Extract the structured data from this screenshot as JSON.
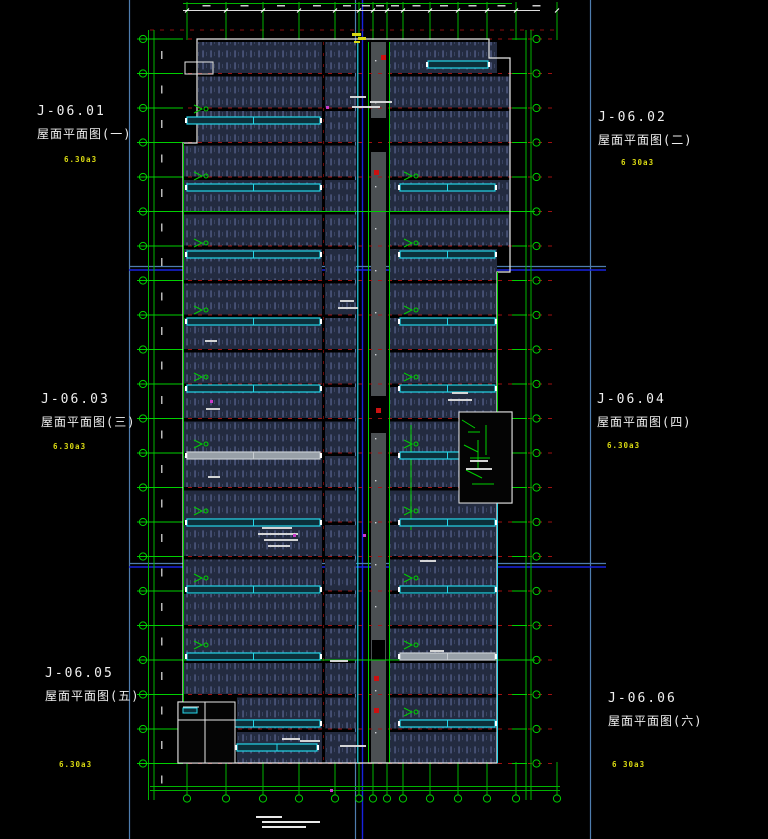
{
  "sheet": {
    "background": "#000000",
    "labels": [
      {
        "code": "J-06.01",
        "title": "屋面平面图(一)",
        "rev": "6.30a3",
        "x": 37,
        "y": 104,
        "rev_x": 64,
        "rev_y": 155
      },
      {
        "code": "J-06.02",
        "title": "屋面平面图(二)",
        "rev": "6 30a3",
        "x": 598,
        "y": 110,
        "rev_x": 621,
        "rev_y": 158
      },
      {
        "code": "J-06.03",
        "title": "屋面平面图(三)",
        "rev": "6.30a3",
        "x": 41,
        "y": 392,
        "rev_x": 53,
        "rev_y": 442
      },
      {
        "code": "J-06.04",
        "title": "屋面平面图(四)",
        "rev": "6.30a3",
        "x": 597,
        "y": 392,
        "rev_x": 607,
        "rev_y": 441
      },
      {
        "code": "J-06.05",
        "title": "屋面平面图(五)",
        "rev": "6.30a3",
        "x": 45,
        "y": 666,
        "rev_x": 59,
        "rev_y": 760
      },
      {
        "code": "J-06.06",
        "title": "屋面平面图(六)",
        "rev": "6 30a3",
        "x": 608,
        "y": 691,
        "rev_x": 612,
        "rev_y": 760
      }
    ]
  },
  "drawing": {
    "colors": {
      "bg": "#000000",
      "divider_light": "#4e7dae",
      "divider_bright": "#1822e0",
      "panel_base": "#232b40",
      "panel_dash": "#49547a",
      "corridor": "#4b5053",
      "axis_red": "#b01212",
      "grid_green": "#00b400",
      "grid_green_bright": "#00d000",
      "outline_white": "#e8e8e8",
      "skylight_cyan": "#25d5e8",
      "skylight_fill": "#0c2f3a",
      "skylight_gray": "#98a0a8",
      "skylight_gray_edge": "#c8cdd2",
      "rev_yellow": "#d9d912",
      "magenta": "#cc3ccc",
      "red_block": "#cc1111",
      "white_bits": "#dddddd"
    },
    "dividers": {
      "v_light": [
        129.5,
        355.5,
        590.5
      ],
      "v_bright": [
        362.5
      ],
      "h_light": [
        266.5,
        563.5
      ],
      "h_bright": [
        270,
        567
      ],
      "h_x1": 129,
      "h_x2": 606
    },
    "axes": {
      "ys_start": 39,
      "ys_step": 34.5,
      "ys_count": 22,
      "xs": [
        187,
        226,
        263,
        299,
        335,
        359,
        373,
        387,
        403,
        430,
        458,
        487,
        516,
        557
      ]
    },
    "grid": {
      "left_x": [
        148.5,
        154
      ],
      "right_x": [
        526,
        531
      ],
      "bubble_left_x": 143,
      "bubble_right_x": 536.5,
      "bubble_r": 3.6,
      "bottom_y": [
        786.5,
        790.5
      ],
      "bottom_bubble_y": 798.5,
      "top_dim_y": 10.5,
      "top_green_y": 3.5
    },
    "building": {
      "outline": [
        [
          197,
          39
        ],
        [
          489,
          39
        ],
        [
          489,
          58
        ],
        [
          510,
          58
        ],
        [
          510,
          272
        ],
        [
          497,
          272
        ],
        [
          497,
          412
        ],
        [
          512,
          412
        ],
        [
          512,
          503
        ],
        [
          497,
          503
        ],
        [
          497,
          763
        ],
        [
          178,
          763
        ],
        [
          178,
          702
        ],
        [
          183,
          702
        ],
        [
          183,
          143
        ],
        [
          197,
          143
        ]
      ]
    },
    "panels": {
      "band_y0": 42,
      "band_h": 31,
      "band_step": 34.5,
      "band_count": 21,
      "left": {
        "x": 184,
        "w": 138,
        "top_x": 198,
        "top_w": 124,
        "annex_x": 237,
        "annex_w": 85
      },
      "mid": {
        "x": 325,
        "w": 31
      },
      "right": {
        "x": 390,
        "w": 107,
        "ext_w": 120
      }
    },
    "corridor": {
      "x": 371,
      "w": 15,
      "y": 42,
      "h": 721,
      "black_rects": [
        [
          371,
          118,
          15,
          34
        ],
        [
          371,
          396,
          15,
          37
        ],
        [
          372,
          640,
          13,
          20
        ]
      ],
      "red_squares": [
        [
          381,
          55
        ],
        [
          374,
          170
        ],
        [
          376,
          408
        ],
        [
          374,
          676
        ],
        [
          374,
          708
        ]
      ]
    },
    "bars": {
      "h": 7,
      "left": {
        "x": 187,
        "w": 133,
        "rows": [
          117,
          184,
          251,
          318,
          385,
          452,
          519,
          586,
          653,
          720
        ],
        "gray_rows": [
          452
        ]
      },
      "right": {
        "x": 400,
        "w": 95,
        "rows": [
          184,
          251,
          318,
          385,
          452,
          519,
          586,
          653,
          720
        ],
        "gray_rows": [
          653
        ],
        "extra": [
          [
            428,
            61,
            60
          ]
        ]
      },
      "annex_bar": [
        237,
        744,
        80
      ]
    },
    "well": {
      "x": 459,
      "y": 412,
      "w": 53,
      "h": 91,
      "lines": [
        [
          462,
          420,
          475,
          428
        ],
        [
          468,
          432,
          480,
          432
        ],
        [
          464,
          445,
          478,
          452
        ],
        [
          470,
          458,
          490,
          458
        ],
        [
          466,
          470,
          482,
          478
        ],
        [
          472,
          484,
          494,
          484
        ],
        [
          478,
          440,
          478,
          470
        ],
        [
          486,
          425,
          486,
          455
        ]
      ]
    },
    "annex": {
      "x": 178,
      "y": 702,
      "w": 57,
      "h": 61,
      "lines": [
        [
          178,
          720,
          235,
          720
        ],
        [
          205,
          702,
          205,
          763
        ],
        [
          183,
          707,
          199,
          707
        ]
      ],
      "cyan": [
        183,
        708,
        14,
        5
      ]
    },
    "details": {
      "green_verticals": [
        [
          368.5,
          42,
          763
        ],
        [
          389.5,
          42,
          763
        ],
        [
          411,
          425,
          530
        ]
      ],
      "green_hlines": [
        [
          150,
          535,
          211.5
        ],
        [
          150,
          535,
          660
        ]
      ],
      "cyan_vertical": [
        357.8,
        42,
        763
      ],
      "step_rect": [
        185,
        62,
        28,
        12
      ],
      "magenta": [
        [
          293,
          534
        ],
        [
          363,
          534
        ],
        [
          326,
          106
        ],
        [
          330,
          789
        ],
        [
          210,
          400
        ]
      ],
      "yellow": [
        [
          352,
          33,
          9,
          3
        ],
        [
          358,
          37,
          8,
          3
        ],
        [
          354,
          41,
          6,
          2
        ]
      ],
      "white_bits": [
        [
          350,
          96,
          16
        ],
        [
          370,
          101,
          22
        ],
        [
          352,
          106,
          28
        ],
        [
          262,
          527,
          30
        ],
        [
          258,
          533,
          40
        ],
        [
          264,
          539,
          34
        ],
        [
          268,
          545,
          22
        ],
        [
          340,
          300,
          14
        ],
        [
          338,
          307,
          20
        ],
        [
          452,
          392,
          16
        ],
        [
          448,
          399,
          24
        ],
        [
          470,
          460,
          18
        ],
        [
          466,
          468,
          26
        ],
        [
          205,
          340,
          12
        ],
        [
          206,
          408,
          14
        ],
        [
          208,
          476,
          12
        ],
        [
          420,
          560,
          16
        ],
        [
          330,
          660,
          18
        ],
        [
          430,
          650,
          14
        ],
        [
          300,
          740,
          20
        ],
        [
          340,
          745,
          26
        ],
        [
          282,
          738,
          18
        ]
      ],
      "notes": [
        [
          256,
          816,
          26
        ],
        [
          262,
          821,
          58
        ],
        [
          262,
          826,
          44
        ]
      ]
    }
  }
}
